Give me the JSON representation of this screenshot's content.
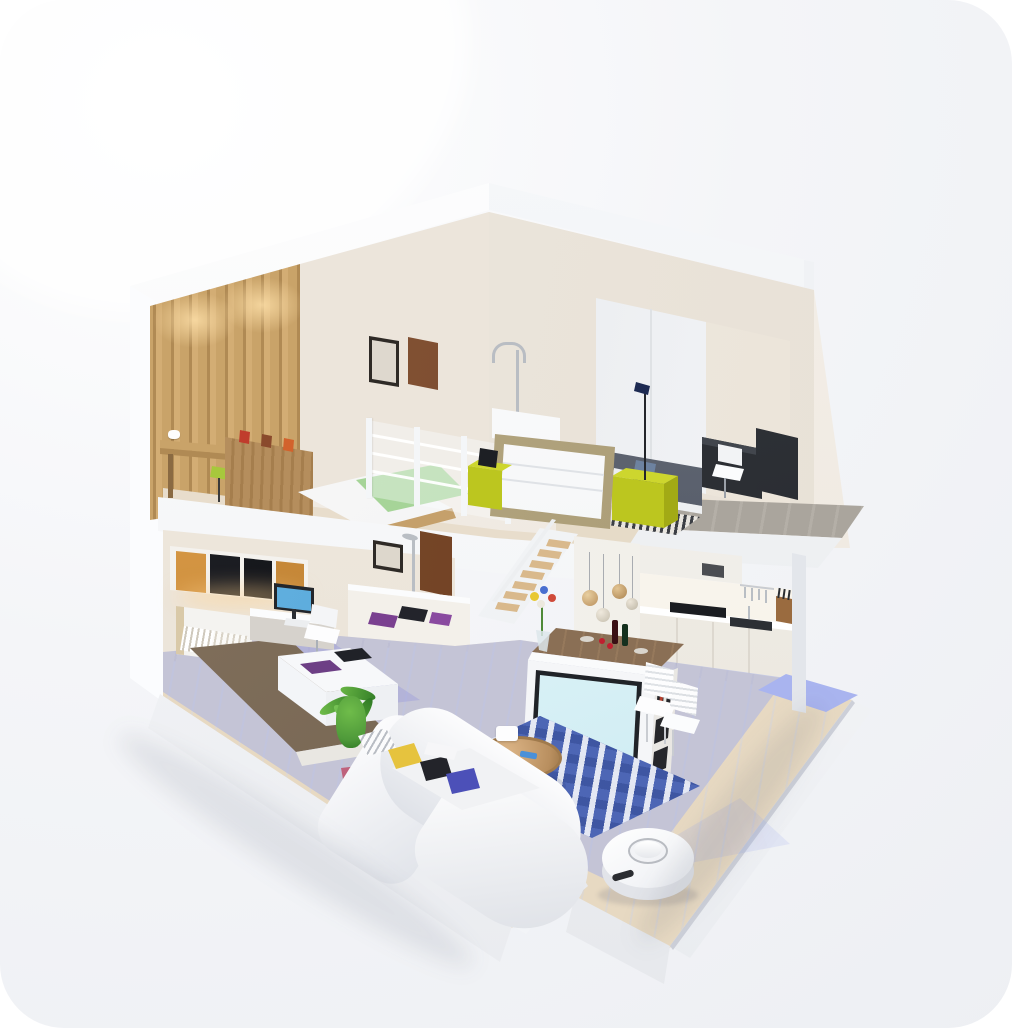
{
  "meta": {
    "description": "3D isometric cutaway render of a two-story loft apartment with a robot vacuum cleaning the ground floor",
    "text_content": "none — the image contains no visible text, labels or numbers"
  },
  "palette": {
    "card_light": "#ffffff",
    "card_mid": "#f4f5f8",
    "card_dark": "#edeff3",
    "shell": "#fbfcfe",
    "shell_shade": "#e9ebef",
    "wall_beige": "#ece5db",
    "wall_beige_dark": "#e0d6c8",
    "wood_light": "#c9a369",
    "wood_mid": "#b08a54",
    "wood_dark": "#8a6a42",
    "wood_floor": "#e7d9c2",
    "deck_gray": "#aaa59d",
    "chartreuse": "#bcc61f",
    "chartreuse_light": "#cdd62e",
    "chartreuse_dark": "#a2aa15",
    "green_blanket": "#9bce8e",
    "brown_blanket": "#6e5c49",
    "navy_bed": "#4a4f59",
    "rug_blue": "#4d66b5",
    "floor_lavender": "#a8b2e8",
    "patch_blue": "#a9b4ef",
    "stool_blue": "#42aee4",
    "monitor_blue": "#58a8d8",
    "screen_cyan": "#d9f1f6",
    "amber_light": "#e8a84c",
    "dark_panel": "#1b1d22",
    "door_brown": "#7a4a30",
    "sofa_white": "#f6f7f9",
    "plant_green": "#4f9a3a",
    "pot_pink": "#b75a74",
    "wine_red": "#c01f2f",
    "pillow_yellow": "#e6c33e",
    "pillow_indigo": "#4c50b8"
  },
  "scene": {
    "labels": {
      "building": "cutaway apartment model",
      "roof": "white roof slab",
      "loft_bedroom": "loft bedroom with green blanket bed, wood wardrobe wall and desk",
      "master_bedroom": "upper bedroom with dark bed, chartreuse cube nightstands and desk",
      "board": "framed white panel leaning on loft edge",
      "railing": "glass loft railing",
      "deck": "gray wood balcony deck",
      "stairs": "wooden staircase",
      "kids_bedroom": "ground-floor bedroom with brown blanket bed, desk and monitor",
      "bathroom": "bathroom with mirror, sink, shower and wooden door",
      "kitchen": "kitchen with white cabinets, cooktop, sink, utensils and pendant lamps",
      "island": "kitchen island with TV, bookshelf, flowers and dining chairs",
      "living_room": "living room with white curved sofa, blue patterned rug, coffee table and stool",
      "plant": "potted palm plant",
      "robot": "white robot vacuum with lidar turret and blue scanning beam",
      "clean_zone": "lavender highlighted cleaned floor area"
    }
  }
}
